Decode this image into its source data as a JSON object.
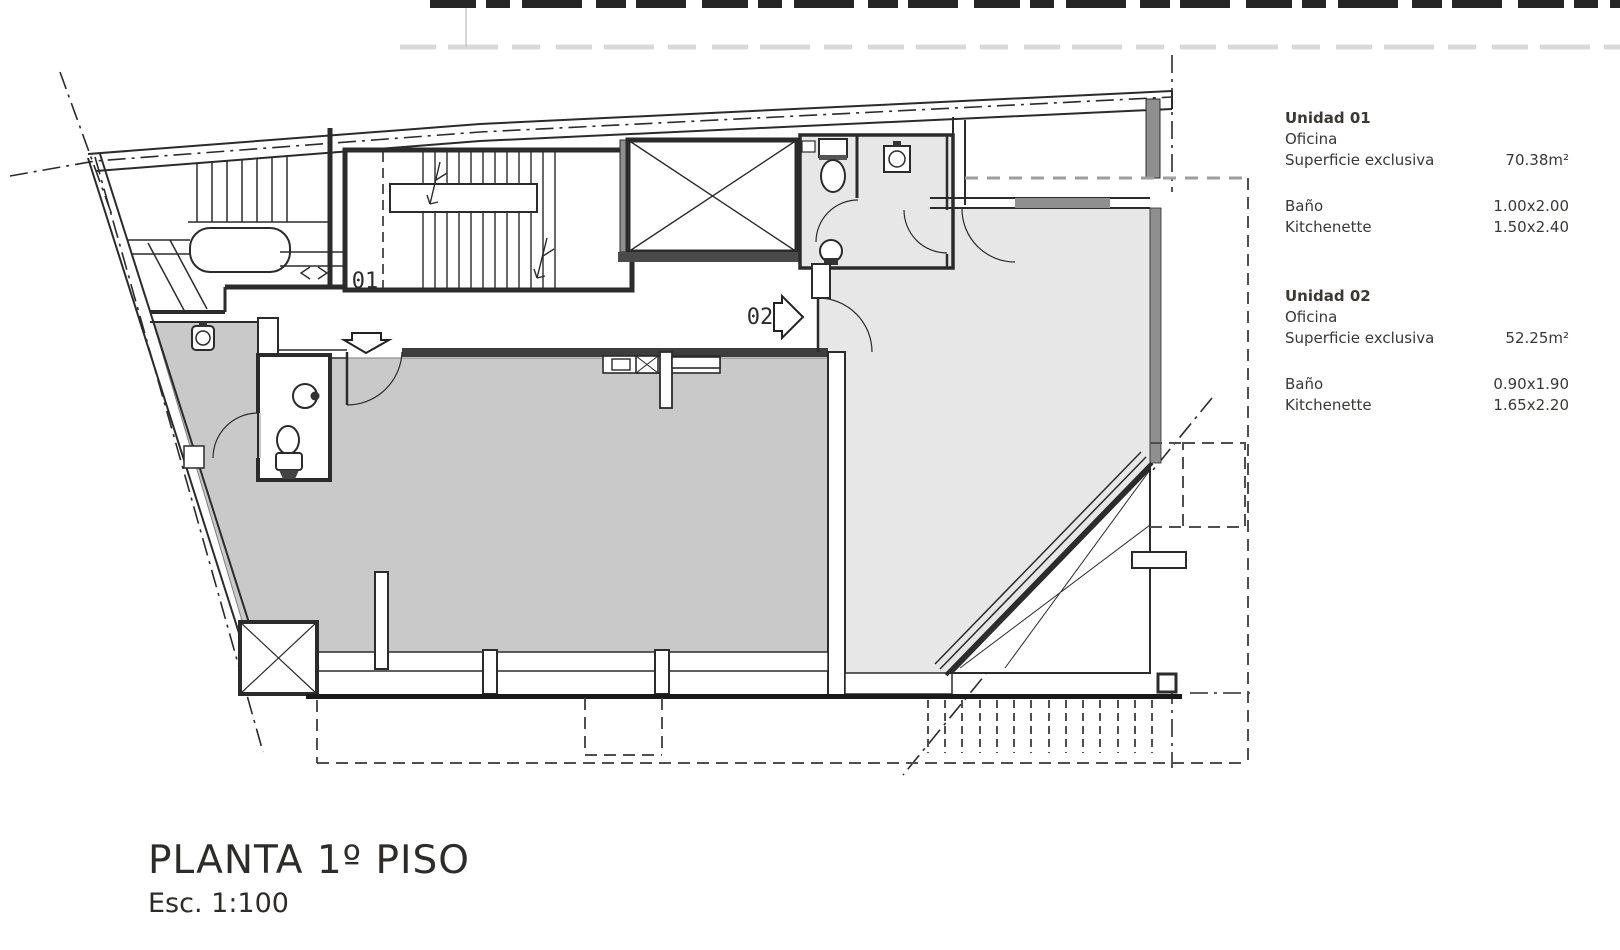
{
  "title_block": {
    "title": "PLANTA 1º PISO",
    "scale": "Esc. 1:100"
  },
  "plan": {
    "entry01_label": "01",
    "entry02_label": "02"
  },
  "panel": {
    "units": [
      {
        "name": "Unidad 01",
        "use": "Oficina",
        "surface_label": "Superficie exclusiva",
        "surface_value": "70.38m²",
        "bath_label": "Baño",
        "bath_value": "1.00x2.00",
        "kitchen_label": "Kitchenette",
        "kitchen_value": "1.50x2.40"
      },
      {
        "name": "Unidad 02",
        "use": "Oficina",
        "surface_label": "Superficie exclusiva",
        "surface_value": "52.25m²",
        "bath_label": "Baño",
        "bath_value": "0.90x1.90",
        "kitchen_label": "Kitchenette",
        "kitchen_value": "1.65x2.20"
      }
    ]
  },
  "colors": {
    "unit01_fill": "#c9c9c9",
    "unit02_fill": "#e7e7e7",
    "wall_line": "#2b2b2b",
    "dark_wall_fill": "#3d3d3d",
    "window_band": "#8f8f8f",
    "dashed_line": "#555555",
    "text": "#3b3833"
  }
}
